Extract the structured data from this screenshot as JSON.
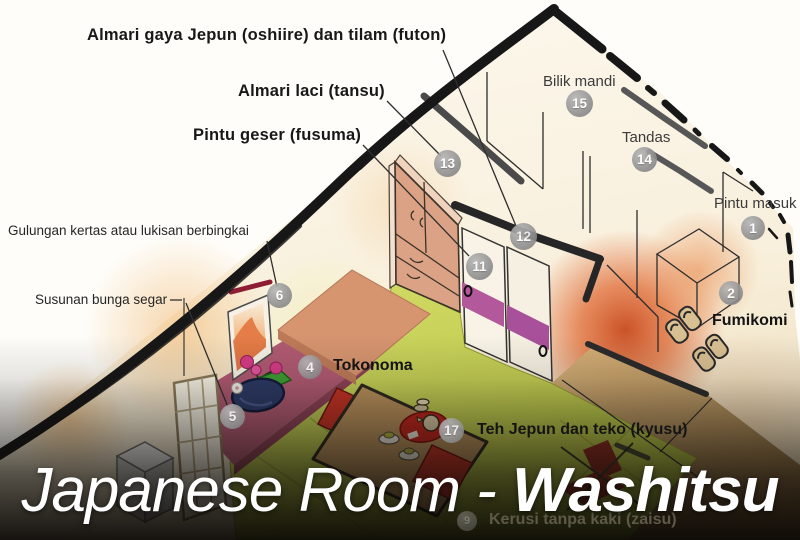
{
  "title": {
    "text_regular": "Japanese Room - ",
    "text_bold": "Washitsu"
  },
  "labels": [
    {
      "id": "oshiire",
      "text": "Almari gaya Jepun (oshiire) dan tilam (futon)"
    },
    {
      "id": "tansu",
      "text": "Almari laci (tansu)"
    },
    {
      "id": "fusuma",
      "text": "Pintu geser (fusuma)"
    },
    {
      "id": "bilik-mandi",
      "text": "Bilik mandi"
    },
    {
      "id": "tandas",
      "text": "Tandas"
    },
    {
      "id": "pintu-masuk",
      "text": "Pintu masuk"
    },
    {
      "id": "fumikomi",
      "text": "Fumikomi"
    },
    {
      "id": "gulungan",
      "text": "Gulungan kertas atau lukisan berbingkai"
    },
    {
      "id": "susunan",
      "text": "Susunan bunga segar"
    },
    {
      "id": "tokonoma",
      "text": "Tokonoma"
    },
    {
      "id": "teh",
      "text": "Teh Jepun dan teko (kyusu)"
    },
    {
      "id": "zaisu",
      "text": "Kerusi tanpa kaki (zaisu)"
    }
  ],
  "badges": [
    {
      "n": "1"
    },
    {
      "n": "2"
    },
    {
      "n": "4"
    },
    {
      "n": "5"
    },
    {
      "n": "6"
    },
    {
      "n": "9"
    },
    {
      "n": "11"
    },
    {
      "n": "12"
    },
    {
      "n": "13"
    },
    {
      "n": "14"
    },
    {
      "n": "15"
    },
    {
      "n": "17"
    }
  ],
  "colors": {
    "wall_outline": "#1b1b1b",
    "partition_grey": "#555555",
    "tatami_green": "#c9d45a",
    "tokonoma_floor": "#b05a72",
    "tansu_salmon": "#dba285",
    "fusuma_stripe": "#b4589c",
    "glow_orange": "#dd5f2e",
    "badge_grey": "#8f8f8f",
    "title_white": "#ffffff"
  }
}
